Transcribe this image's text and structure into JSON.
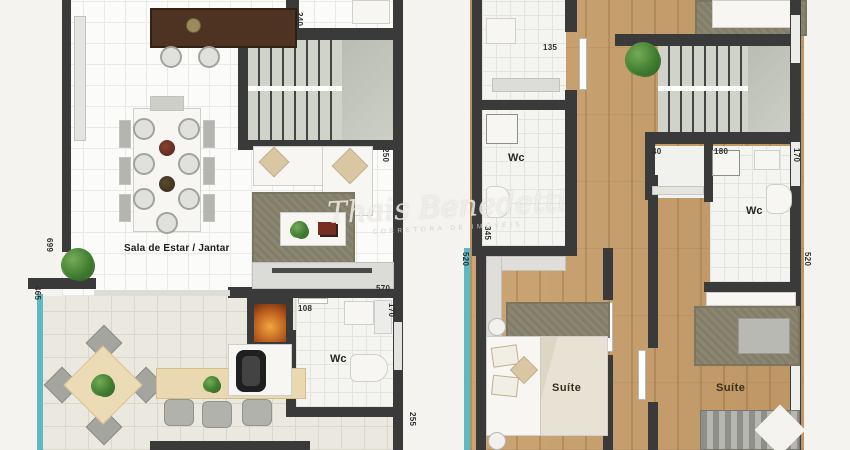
{
  "watermark": {
    "script": "Thais Benedetti",
    "caption": "CORRETORA DE IMÓVEIS"
  },
  "left_plan": {
    "labels": {
      "living_dining": "Sala de Estar / Jantar",
      "wc": "Wc"
    },
    "dimensions": {
      "stair_width": "240",
      "sofa_depth": "250",
      "living_length": "699",
      "terrace_width": "465",
      "wall_length": "570",
      "wc_door": "108",
      "wc_width": "170",
      "terrace_right": "255"
    }
  },
  "right_plan": {
    "labels": {
      "wc_upper": "Wc",
      "wc_middle": "Wc",
      "suite_left": "Suíte",
      "suite_right": "Suíte"
    },
    "dimensions": {
      "hall_door": "135",
      "closet_depth": "40",
      "bath_width": "180",
      "bath_length": "170",
      "suite_left_width": "345",
      "suite_left_length": "520",
      "suite_right_length": "520"
    }
  },
  "colors": {
    "wall": "#3a3a3a",
    "wood_floor": "#c89e6a",
    "balcony_glass": "#5fb9c4",
    "rug": "#8b8671",
    "stair_tread": "#d0d3ca",
    "fire": "#e8953a"
  }
}
